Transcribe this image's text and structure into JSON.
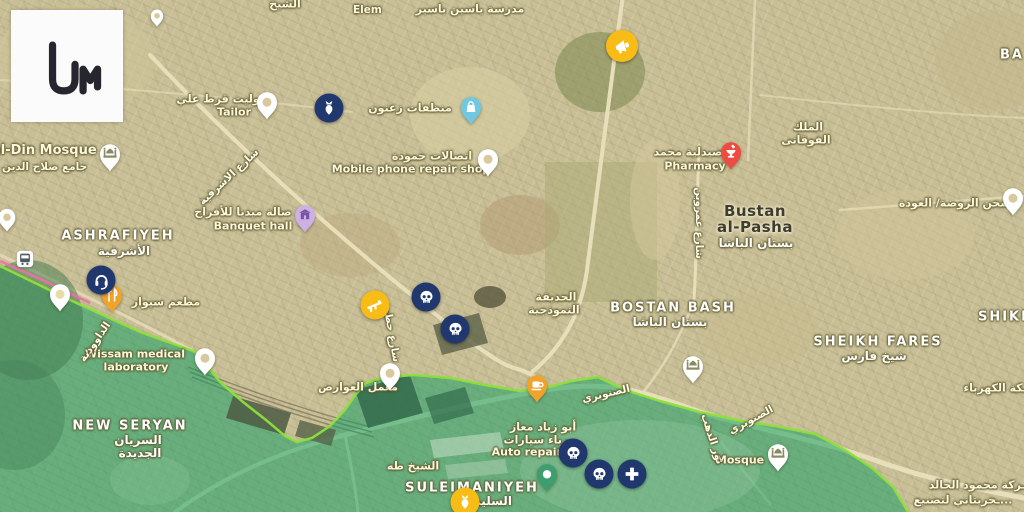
{
  "app": {
    "name": "Liveuamap",
    "logo_text": "um"
  },
  "colors": {
    "event_marker_navy": "#20386e",
    "event_marker_yellow": "#f7bd16",
    "zone_green_fill": "#0f9d62",
    "frontline_green": "#8ce03a",
    "frontline_pink": "#f06eaa",
    "pharmacy_pin_red": "#ee4c41",
    "laundry_pin_blue": "#6fc9e2",
    "banquet_pin_purple": "#cbb1e4",
    "food_pin_amber": "#f0a32a",
    "park_pin_green": "#3f9e6d"
  },
  "districts": [
    {
      "en": "ASHRAFIYEH",
      "ar": "الأشرفية"
    },
    {
      "en": "NEW SERYAN",
      "ar": "السريان",
      "ar2": "الجديدة"
    },
    {
      "en": "SULEIMANIYEH",
      "ar": "السليمانية"
    },
    {
      "en": "BOSTAN BASH",
      "ar": "بستان الباشا"
    },
    {
      "en": "SHEIKH FARES",
      "ar": "شيخ فارس"
    },
    {
      "en": "SHIKH"
    },
    {
      "en": "BA"
    },
    {
      "en": "Bustan",
      "en2": "al-Pasha",
      "ar": "بستان الباشا"
    }
  ],
  "pois": [
    {
      "en": "al-Din Mosque",
      "ar": "جامع صلاح الدين"
    },
    {
      "ar": "جوليت قرط علي",
      "en": "Tailor"
    },
    {
      "ar": "منظفات زعنون"
    },
    {
      "ar": "اتصالات حمودة",
      "en": "Mobile phone repair shop"
    },
    {
      "ar": "صيدلية محمد",
      "en": "Pharmacy"
    },
    {
      "ar": "صالة ميديا للأفراح",
      "en": "Banquet hall"
    },
    {
      "ar": "مطعم سيوار"
    },
    {
      "en": "Wissam medical",
      "en2": "laboratory"
    },
    {
      "ar": "معمل العوارض"
    },
    {
      "ar": "أبو زياد معاز",
      "ar2": "ـرباء سيارات",
      "en": "Auto repair s"
    },
    {
      "en": "Mosque"
    },
    {
      "ar": "شحن الروضة/ العودة"
    },
    {
      "ar": "ـكة الكهرباء"
    },
    {
      "ar": "ـركة محمود الخالد",
      "ar2": "ـحريتاني لتصنيع..."
    },
    {
      "ar": "الملك",
      "ar2": "الفوقانى"
    },
    {
      "ar": "الحديقة",
      "ar2": "النموذجية"
    },
    {
      "en": "Elem",
      "ar": "مدرسة ياسين باسير"
    },
    {
      "ar": "الشيخ طه"
    },
    {
      "ar": "الشيخ"
    }
  ],
  "streets": [
    {
      "ar": "شارع الاشرفية"
    },
    {
      "ar": "الصنوبري"
    },
    {
      "ar": "الصنوبري"
    },
    {
      "ar": "الداوودية"
    },
    {
      "ar": "شارع عمروبن"
    },
    {
      "ar": "نور الذهب"
    },
    {
      "ar": "شارع حطين"
    }
  ],
  "events": [
    {
      "name": "announcement-marker",
      "icon": "megaphone-icon",
      "color": "#f7bd16"
    },
    {
      "name": "shelling-marker",
      "icon": "bomb-icon",
      "color": "#20386e"
    },
    {
      "name": "audio-report-marker",
      "icon": "headphones-icon",
      "color": "#20386e"
    },
    {
      "name": "firefight-marker",
      "icon": "rifle-icon",
      "color": "#f7bd16"
    },
    {
      "name": "casualties-marker-1",
      "icon": "skull-icon",
      "color": "#20386e"
    },
    {
      "name": "casualties-marker-2",
      "icon": "skull-icon",
      "color": "#20386e"
    },
    {
      "name": "casualties-marker-3",
      "icon": "skull-icon",
      "color": "#20386e"
    },
    {
      "name": "casualties-marker-4",
      "icon": "skull-icon",
      "color": "#20386e"
    },
    {
      "name": "medical-marker",
      "icon": "medical-cross-icon",
      "color": "#20386e"
    },
    {
      "name": "explosion-marker",
      "icon": "bomb-icon",
      "color": "#f7bd16"
    }
  ]
}
